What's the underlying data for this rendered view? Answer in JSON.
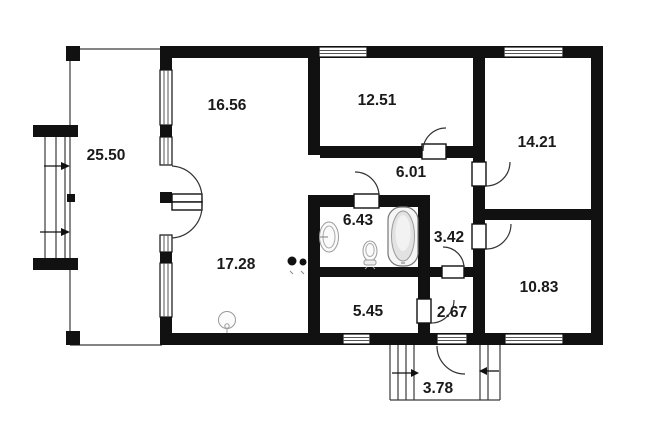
{
  "plan": {
    "type": "floor-plan",
    "background": "#ffffff",
    "wall_color": "#111111",
    "line_color": "#3a3a3a",
    "label_color": "#1a1a1a"
  },
  "rooms": {
    "terrace": {
      "area": "25.50"
    },
    "room_top_left": {
      "area": "16.56"
    },
    "room_top_middle": {
      "area": "12.51"
    },
    "room_top_right": {
      "area": "14.21"
    },
    "hallway": {
      "area": "6.01"
    },
    "bathroom": {
      "area": "6.43"
    },
    "inner_hall": {
      "area": "3.42"
    },
    "living_room": {
      "area": "17.28"
    },
    "room_bottom_right": {
      "area": "10.83"
    },
    "room_bottom_middle": {
      "area": "5.45"
    },
    "vestibule": {
      "area": "2.67"
    },
    "porch": {
      "area": "3.78"
    }
  },
  "icons": {
    "bathtub": "bathtub-icon",
    "sink": "sink-icon",
    "toilet": "toilet-icon",
    "stove": "stove-icon",
    "ceiling_light": "ceiling-light-icon",
    "stair_arrows": "direction-arrow-icon",
    "windows": "window-icon",
    "doors": "door-swing-icon"
  }
}
